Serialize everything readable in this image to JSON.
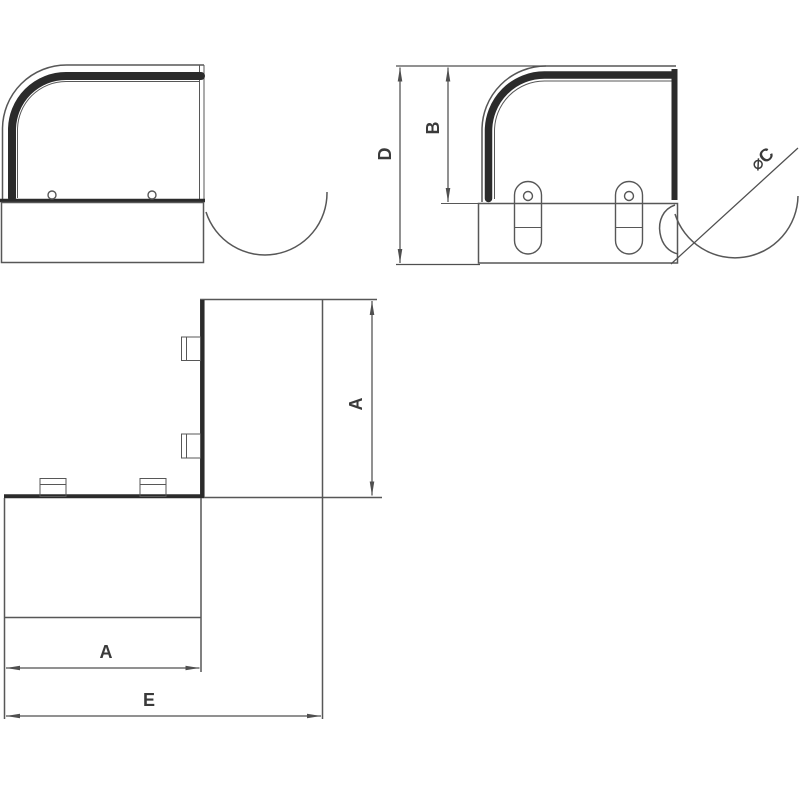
{
  "drawing": {
    "kind": "technical-drawing",
    "labels": {
      "overall_height": "D",
      "bend_height": "B",
      "spigot_diameter": "⌀C",
      "duct_width_side": "A",
      "duct_width_bottom": "A",
      "overall_length": "E"
    },
    "colors": {
      "background": "#ffffff",
      "thin": "#575757",
      "thick": "#2b2b2b",
      "dim": "#4f4f4f",
      "text": "#3a3a3a"
    }
  }
}
